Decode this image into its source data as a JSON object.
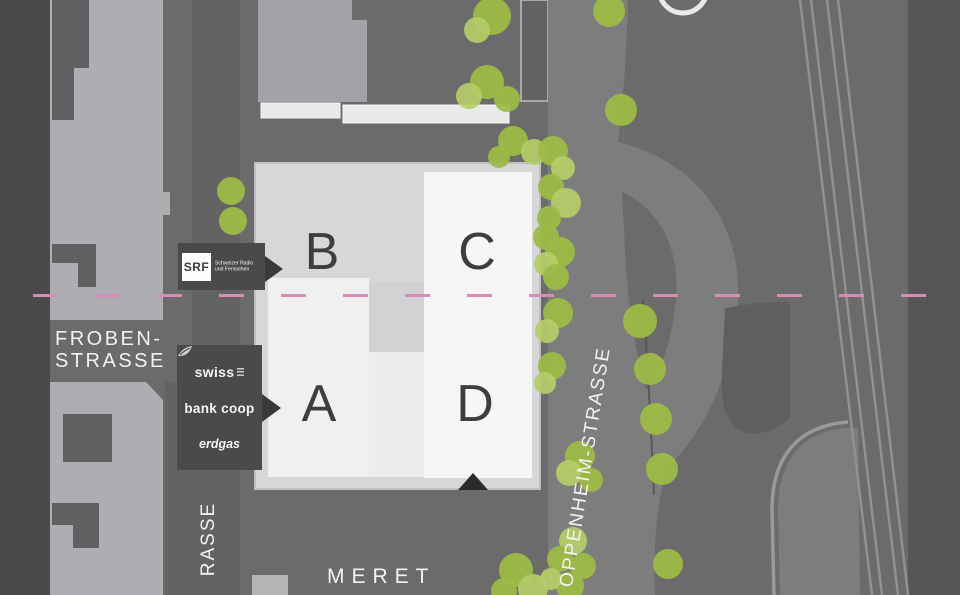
{
  "colors": {
    "bg": "#6b6b6b",
    "bg_dark_strip": "#4a4a4a",
    "block_light": "#aeaeb2",
    "footprint": "#606062",
    "side_street": "#636363",
    "top_bldg": "#a3a3a7",
    "street": "#7d7d7d",
    "building_base": "#d7d7d9",
    "building_white": "#f6f6f7",
    "label_box": "#4a4a4c",
    "letter": "#3e3e40",
    "rail": "#919191",
    "accent_pink": "#d98cba",
    "tree": "#9cba45",
    "tree_light": "#b6cd68"
  },
  "buildings": {
    "a": "A",
    "b": "B",
    "c": "C",
    "d": "D"
  },
  "streets": {
    "froben_line1": "FROBEN-",
    "froben_line2": "STRASSE",
    "side_street_partial": "RASSE",
    "oppenheim": "OPPENHEIM-STRASSE",
    "meret": "MERET"
  },
  "tenant_labels": {
    "srf": {
      "logo": "SRF",
      "name_line1": "Schweizer Radio",
      "name_line2": "und Fernsehen"
    },
    "swiss": "swiss",
    "bank_coop": "bank coop",
    "erdgas": "erdgas"
  }
}
